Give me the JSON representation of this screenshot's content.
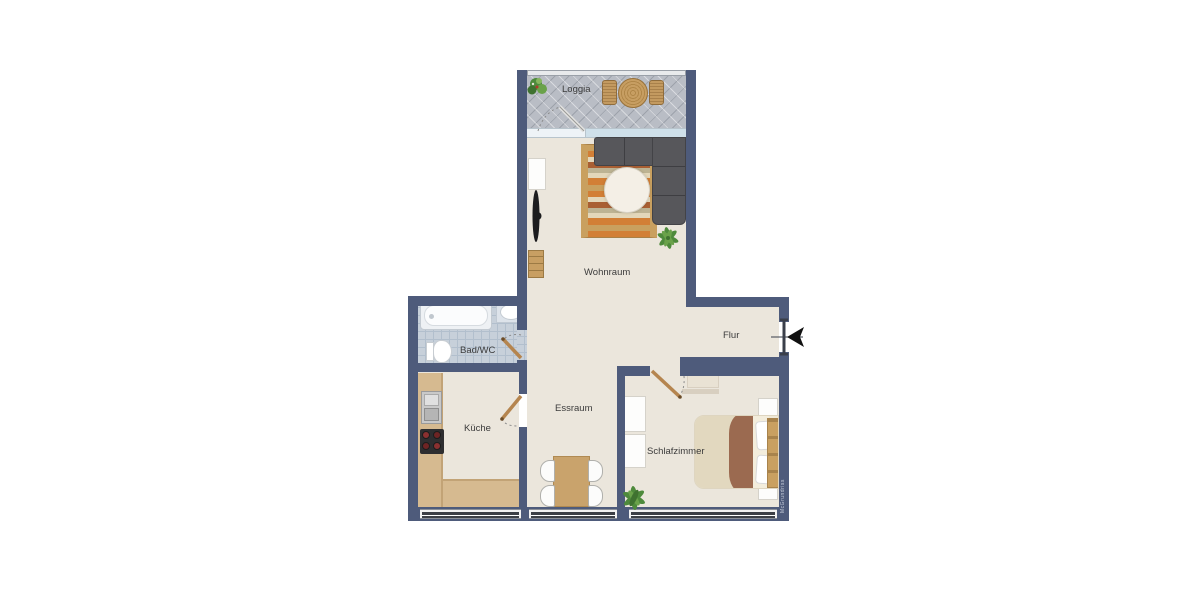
{
  "rooms": {
    "loggia": {
      "label": "Loggia"
    },
    "wohnraum": {
      "label": "Wohnraum"
    },
    "flur": {
      "label": "Flur"
    },
    "bad": {
      "label": "Bad/WC"
    },
    "kueche": {
      "label": "Küche"
    },
    "essraum": {
      "label": "Essraum"
    },
    "schlafzimmer": {
      "label": "Schlafzimmer"
    }
  },
  "watermark": {
    "text": "McGrundriss"
  },
  "colors": {
    "wall": "#4e5b7b",
    "floor": "#ebe6dc",
    "loggia_tile": "#b9bdc5",
    "bath_tile": "#c7d0da",
    "glass": "#cfe0ea",
    "wood": "#c9a36c",
    "counter": "#d6ba90",
    "sofa": "#57575b",
    "blanket": "#9b6a50",
    "rug_orange": "#d27f36",
    "rug_cream": "#e3d7ba",
    "rug_brown": "#a95f33",
    "plant": "#4e8a3c",
    "label_text": "#3b3b3b",
    "door_leaf": "#b5854f"
  }
}
